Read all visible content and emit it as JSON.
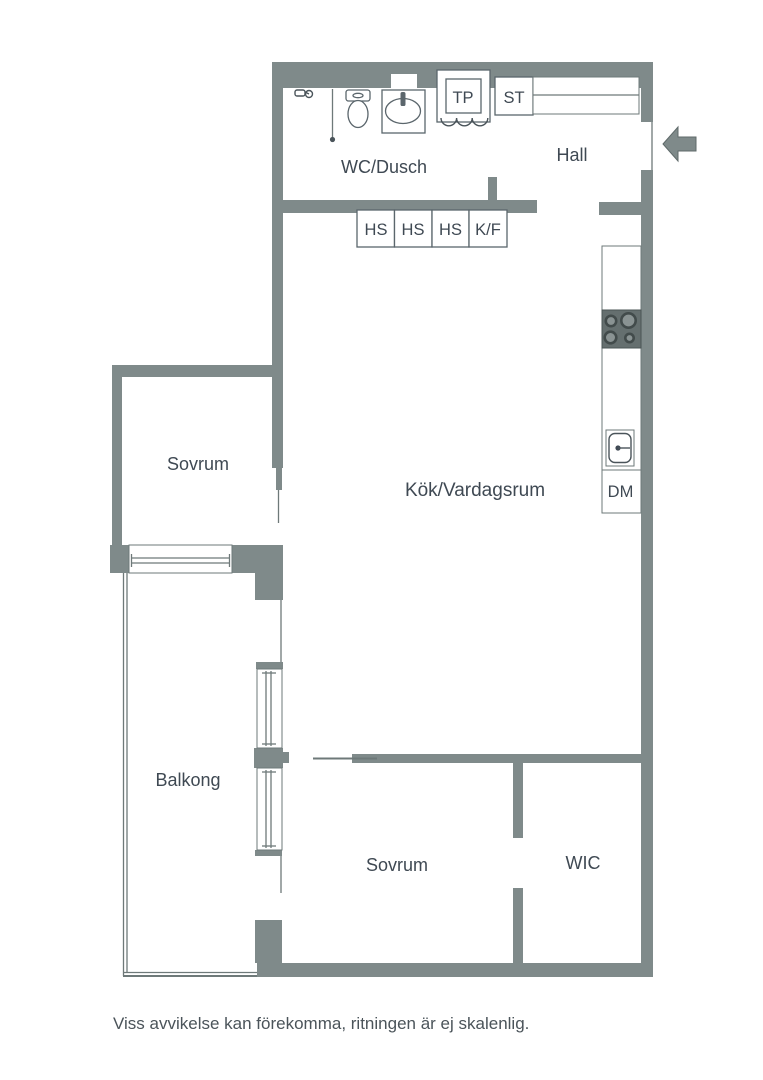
{
  "title": "Apartment floor plan",
  "colors": {
    "wall": "#7f8a8a",
    "thin_line": "#6e7979",
    "fixture_border": "#5b666c",
    "stove_background": "#656f6f",
    "burner_ring": "#424b4b",
    "label_text": "#3f4953",
    "background": "#ffffff"
  },
  "rooms": {
    "wc_shower": "WC/Dusch",
    "hall": "Hall",
    "kitchen_living": "Kök/Vardagsrum",
    "bedroom_left": "Sovrum",
    "balcony": "Balkong",
    "bedroom_lower": "Sovrum",
    "walk_in_closet": "WIC"
  },
  "fixtures": {
    "drying_cabinet": "TP",
    "cleaning_cabinet": "ST",
    "tall_cabinet_1": "HS",
    "tall_cabinet_2": "HS",
    "tall_cabinet_3": "HS",
    "fridge_freezer": "K/F",
    "dishwasher": "DM"
  },
  "footer": {
    "disclaimer": "Viss avvikelse kan förekomma, ritningen är ej skalenlig."
  }
}
